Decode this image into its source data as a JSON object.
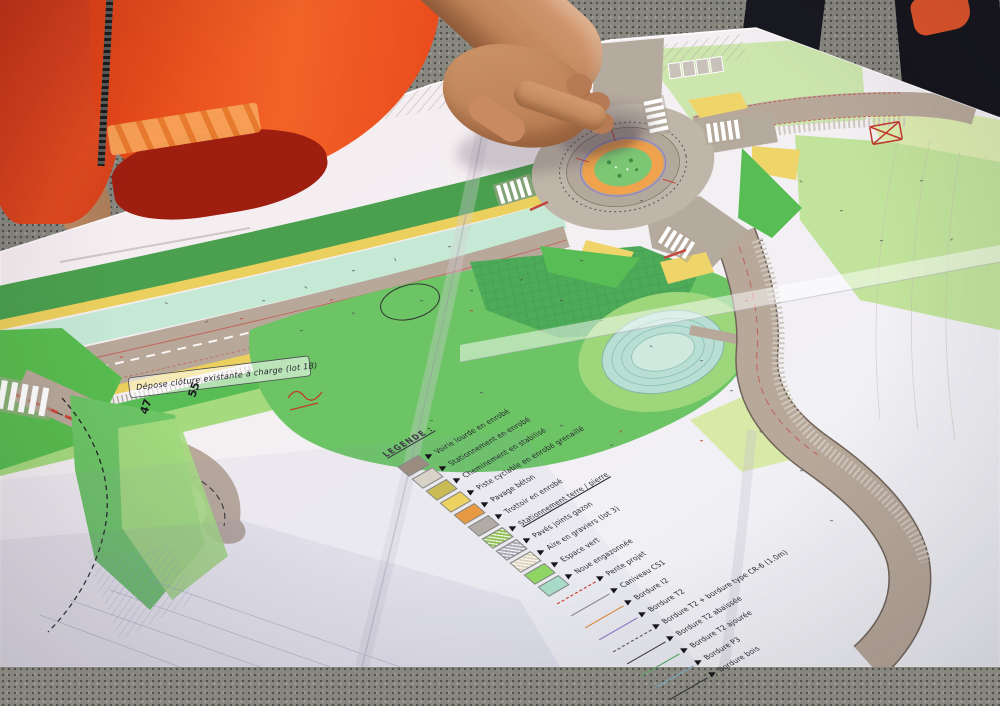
{
  "plan": {
    "handwritten_note": "Dépose clôture existante à charge (lot 1B)",
    "station_numbers": [
      "47",
      "55"
    ],
    "legend": {
      "title": "LEGENDE :",
      "surface_items": [
        {
          "label": "Voirie lourde en enrobé",
          "color": "#9a8d80",
          "pattern": "solid"
        },
        {
          "label": "Stationnement en enrobé",
          "color": "#d9d2c9",
          "pattern": "solid"
        },
        {
          "label": "Cheminement en stabilisé",
          "color": "#c9bc55",
          "pattern": "solid"
        },
        {
          "label": "Piste cyclable en enrobé grenaillé",
          "color": "#ecd25e",
          "pattern": "solid"
        },
        {
          "label": "Pavage béton",
          "color": "#e89a43",
          "pattern": "solid"
        },
        {
          "label": "Trottoir en enrobé",
          "color": "#b3aca6",
          "pattern": "solid"
        },
        {
          "label": "Stationnement terre / pierre",
          "color": "#8fbf52",
          "pattern": "hatch",
          "underlined": true
        },
        {
          "label": "Pavés joints gazon",
          "color": "#a9a9b4",
          "pattern": "hatch"
        },
        {
          "label": "Aire en graviers (lot 3)",
          "color": "#ded3bc",
          "pattern": "hatch"
        },
        {
          "label": "Espace vert",
          "color": "#8ed563",
          "pattern": "solid"
        },
        {
          "label": "Noue engazonnée",
          "color": "#a8dcc8",
          "pattern": "solid"
        }
      ],
      "line_items": [
        {
          "label": "Pente projet",
          "color": "#cc3322",
          "style": "dashed"
        },
        {
          "label": "Caniveau CS1",
          "color": "#8a8a8a",
          "style": "solid"
        },
        {
          "label": "Bordure I2",
          "color": "#e08a3c",
          "style": "solid"
        },
        {
          "label": "Bordure T2",
          "color": "#8877cc",
          "style": "solid"
        },
        {
          "label": "Bordure T2 + bordure type CR-6 (1.0m)",
          "color": "#555555",
          "style": "dashed"
        },
        {
          "label": "Bordure T2 abaissée",
          "color": "#444444",
          "style": "solid"
        },
        {
          "label": "Bordure T2 ajourée",
          "color": "#55aa66",
          "style": "solid"
        },
        {
          "label": "Bordure P3",
          "color": "#7aaabd",
          "style": "solid"
        },
        {
          "label": "Bordure bois",
          "color": "#333333",
          "style": "solid"
        }
      ]
    },
    "map_colors": {
      "paper": "#f3eef1",
      "road_asphalt": "#b8a89a",
      "cycle_lane_yellow": "#ecd05e",
      "verge_green": "#59bd55",
      "lawn_green": "#6cc465",
      "light_green": "#a6da7f",
      "pale_green": "#b9e08c",
      "roundabout_apron_orange": "#f0a24c",
      "center_island_green": "#7cc774",
      "basin_teal": "#b9ded3",
      "mint_strip": "#c6e9d5",
      "red_marking": "#c3463c"
    }
  },
  "photo": {
    "colors": {
      "hi_vis_jacket_orange": "#e8491f",
      "jacket_dark_red": "#9e1e10",
      "reflective_band": "#f7a258",
      "asphalt_ground": "#87867f",
      "dark_clothing": "#15151c",
      "skin": "#c28a62"
    }
  }
}
